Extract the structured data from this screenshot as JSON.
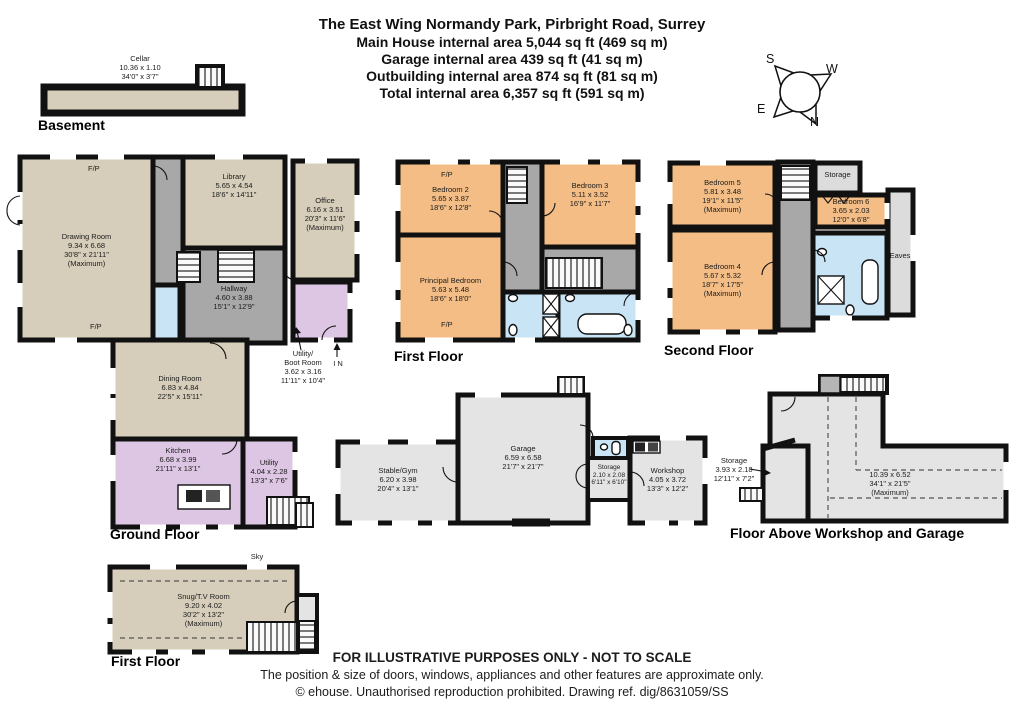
{
  "title": {
    "address": "The East Wing Normandy Park, Pirbright Road, Surrey",
    "main_house": "Main House internal area 5,044 sq ft (469 sq m)",
    "garage": "Garage internal area 439 sq ft (41 sq m)",
    "outbuilding": "Outbuilding internal area 874 sq ft (81 sq m)",
    "total": "Total internal area 6,357 sq ft (591 sq m)"
  },
  "compass": {
    "n": "N",
    "s": "S",
    "e": "E",
    "w": "W"
  },
  "labels": {
    "fp": "F/P",
    "in_arrow": "I N",
    "sky": "Sky",
    "storage": "Storage",
    "eaves": "Eaves"
  },
  "floors": {
    "basement": {
      "caption": "Basement",
      "cellar": {
        "name": "Cellar",
        "metric": "10.36 x 1.10",
        "imperial": "34'0\" x 3'7\""
      }
    },
    "ground": {
      "caption": "Ground Floor",
      "drawing_room": {
        "name": "Drawing Room",
        "metric": "9.34 x 6.68",
        "imperial": "30'8\" x 21'11\"",
        "note": "(Maximum)"
      },
      "library": {
        "name": "Library",
        "metric": "5.65 x 4.54",
        "imperial": "18'6\" x 14'11\""
      },
      "office": {
        "name": "Office",
        "metric": "6.16 x 3.51",
        "imperial": "20'3\" x 11'6\"",
        "note": "(Maximum)"
      },
      "hallway": {
        "name": "Hallway",
        "metric": "4.60 x 3.88",
        "imperial": "15'1\" x 12'9\""
      },
      "boot_room": {
        "name": "Utility/",
        "name2": "Boot Room",
        "metric": "3.62 x 3.16",
        "imperial": "11'11\" x 10'4\""
      },
      "dining_room": {
        "name": "Dining Room",
        "metric": "6.83 x 4.84",
        "imperial": "22'5\" x 15'11\""
      },
      "kitchen": {
        "name": "Kitchen",
        "metric": "6.68 x 3.99",
        "imperial": "21'11\" x 13'1\""
      },
      "utility": {
        "name": "Utility",
        "metric": "4.04 x 2.28",
        "imperial": "13'3\" x 7'6\""
      }
    },
    "first_floor": {
      "caption": "First Floor",
      "bedroom_2": {
        "name": "Bedroom 2",
        "metric": "5.65 x 3.87",
        "imperial": "18'6\" x 12'8\""
      },
      "bedroom_3": {
        "name": "Bedroom 3",
        "metric": "5.11 x 3.52",
        "imperial": "16'9\" x 11'7\""
      },
      "principal_bedroom": {
        "name": "Principal Bedroom",
        "metric": "5.63 x 5.48",
        "imperial": "18'6\" x 18'0\""
      }
    },
    "second_floor": {
      "caption": "Second Floor",
      "bedroom_5": {
        "name": "Bedroom 5",
        "metric": "5.81 x 3.48",
        "imperial": "19'1\" x 11'5\"",
        "note": "(Maximum)"
      },
      "bedroom_6": {
        "name": "Bedroom 6",
        "metric": "3.65 x 2.03",
        "imperial": "12'0\" x 6'8\""
      },
      "bedroom_4": {
        "name": "Bedroom 4",
        "metric": "5.67 x 5.32",
        "imperial": "18'7\" x 17'5\"",
        "note": "(Maximum)"
      }
    },
    "outbuilding": {
      "stable_gym": {
        "name": "Stable/Gym",
        "metric": "6.20 x 3.98",
        "imperial": "20'4\" x 13'1\""
      },
      "garage": {
        "name": "Garage",
        "metric": "6.59 x 6.58",
        "imperial": "21'7\" x 21'7\""
      },
      "storage": {
        "name": "Storage",
        "metric": "2.10 x 2.08",
        "imperial": "6'11\" x 6'10\""
      },
      "workshop": {
        "name": "Workshop",
        "metric": "4.05 x 3.72",
        "imperial": "13'3\" x 12'2\""
      }
    },
    "floor_above": {
      "caption": "Floor Above Workshop and Garage",
      "storage": {
        "name": "Storage",
        "metric": "3.93 x 2.18",
        "imperial": "12'11\" x 7'2\""
      },
      "open_area": {
        "metric": "10.39 x 6.52",
        "imperial": "34'1\" x 21'5\"",
        "note": "(Maximum)"
      }
    },
    "snug_first_floor": {
      "caption": "First Floor",
      "snug": {
        "name": "Snug/T.V Room",
        "metric": "9.20 x 4.02",
        "imperial": "30'2\" x 13'2\"",
        "note": "(Maximum)"
      }
    }
  },
  "footer": {
    "line1": "FOR ILLUSTRATIVE PURPOSES ONLY - NOT TO SCALE",
    "line2": "The position & size of doors, windows, appliances and other features are approximate only.",
    "line3": "© ehouse. Unauthorised reproduction prohibited. Drawing ref. dig/8631059/SS"
  },
  "colors": {
    "wall": "#111111",
    "reception_tan": "#d6cdba",
    "bedroom_orange": "#f3bd85",
    "kitchen_purple": "#dcc6e3",
    "bathroom_blue": "#c9e5f5",
    "hallway_gray": "#a8a8a8",
    "outbuilding_gray": "#e4e4e4",
    "storage_gray": "#dcdcdc"
  }
}
